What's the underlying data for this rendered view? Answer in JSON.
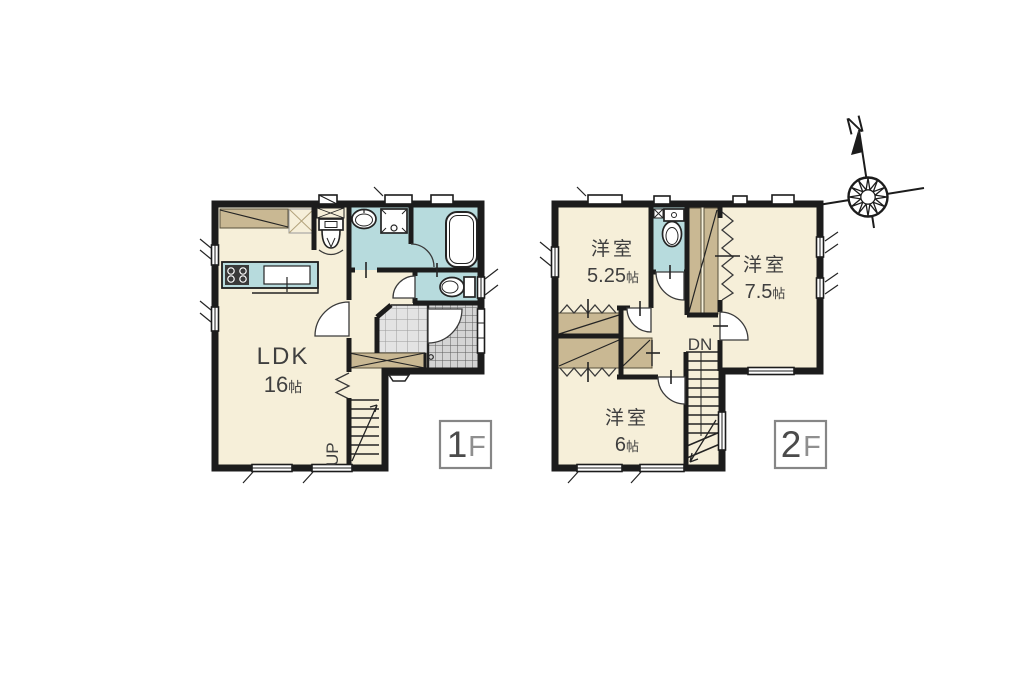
{
  "colors": {
    "floor": "#F6EFD9",
    "wet": "#B7DBDD",
    "closet": "#C9B893",
    "wall": "#1C1C1C",
    "tile_hall": "#E3E3E3",
    "tile_genkan": "#D4D4D4",
    "label": "#3F3F3F",
    "badge_border": "#868686",
    "badge_num": "#4B4B4B",
    "badge_suffix": "#8F8F8F"
  },
  "floor1": {
    "badge": {
      "num": "1",
      "suffix": "F"
    },
    "rooms": [
      {
        "name": "LDK",
        "value": "16",
        "unit": "帖"
      }
    ],
    "stair_label": "UP"
  },
  "floor2": {
    "badge": {
      "num": "2",
      "suffix": "F"
    },
    "rooms": [
      {
        "name": "洋室",
        "value": "5.25",
        "unit": "帖"
      },
      {
        "name": "洋室",
        "value": "7.5",
        "unit": "帖"
      },
      {
        "name": "洋室",
        "value": "6",
        "unit": "帖"
      }
    ],
    "stair_label": "DN"
  },
  "compass": {
    "label": "N"
  }
}
